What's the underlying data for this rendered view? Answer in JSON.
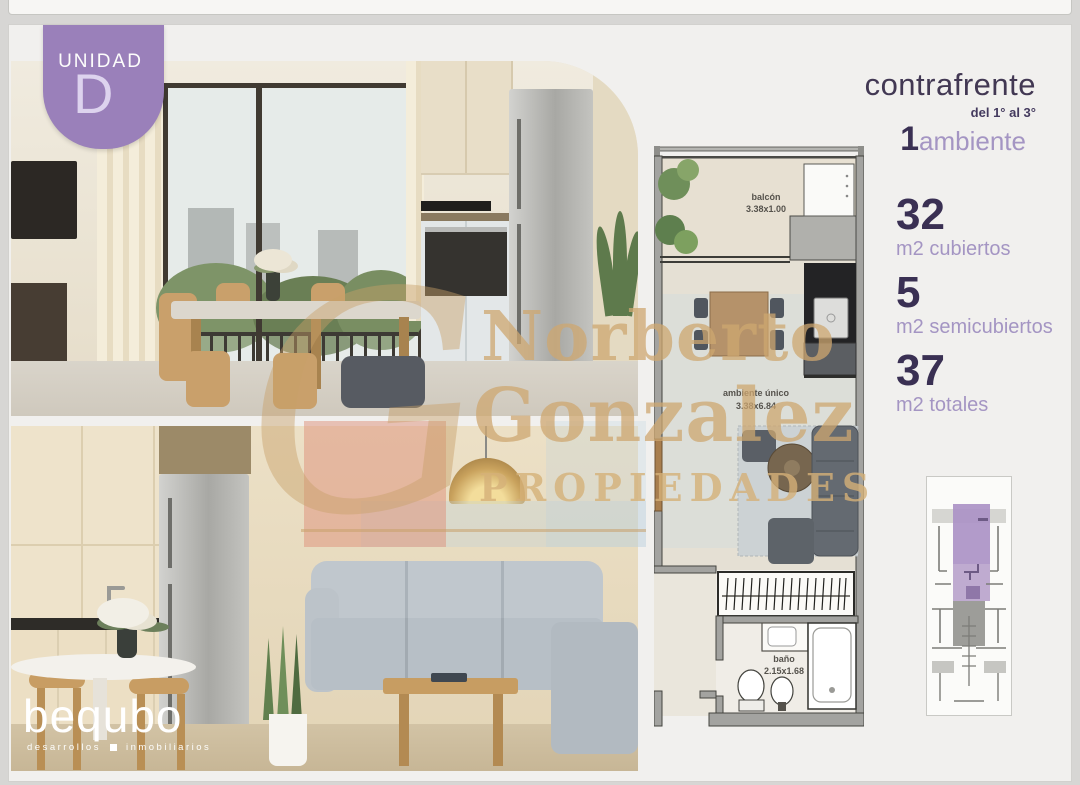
{
  "badge": {
    "label": "UNIDAD",
    "letter": "D"
  },
  "header": {
    "orientation": "contrafrente",
    "floors": "del 1° al 3°",
    "rooms_count": "1",
    "rooms_label": "ambiente"
  },
  "specs": {
    "covered": {
      "value": "32",
      "label": "m2 cubiertos"
    },
    "semicovered": {
      "value": "5",
      "label": "m2 semicubiertos"
    },
    "total": {
      "value": "37",
      "label": "m2 totales"
    }
  },
  "floorplan": {
    "balcony": {
      "name": "balcón",
      "dims": "3.38x1.00"
    },
    "mainroom": {
      "name": "ambiente único",
      "dims": "3.38x6.84"
    },
    "bathroom": {
      "name": "baño",
      "dims": "2.15x1.68"
    }
  },
  "watermark": {
    "monogram": "G",
    "line1": "Norberto",
    "line2": "Gonzalez",
    "line3": "PROPIEDADES"
  },
  "brand": {
    "logo": "bequbo",
    "tagline_left": "desarrollos",
    "tagline_right": "inmobiliarios"
  },
  "colors": {
    "accent_purple": "#9a80ba",
    "dark_purple": "#3a3053",
    "light_purple": "#a495c3",
    "watermark_gold": "#c89e66",
    "highlight_unit": "#ab93c6"
  }
}
